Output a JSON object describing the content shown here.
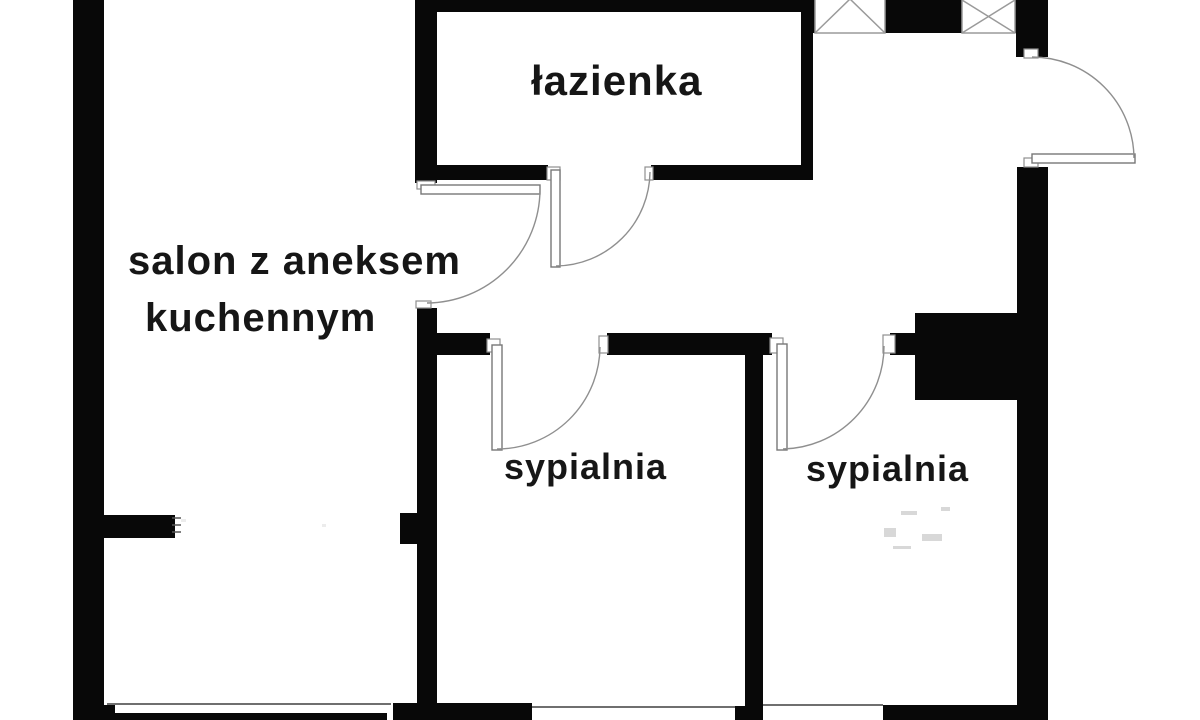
{
  "plan": {
    "type": "apartment-floor-plan",
    "rooms": {
      "bathroom": {
        "label": "łazienka"
      },
      "living_room": {
        "line1": "salon z aneksem",
        "line2": "kuchennym"
      },
      "bedroom_1": {
        "label": "sypialnia"
      },
      "bedroom_2": {
        "label": "sypialnia"
      }
    },
    "symbols": {
      "door_arcs": 5,
      "window_lines": 3,
      "crossed_boxes": 2
    },
    "colors": {
      "wall": "#080808",
      "background": "#ffffff",
      "thin_line": "#8f8f8f",
      "text": "#161616"
    }
  }
}
